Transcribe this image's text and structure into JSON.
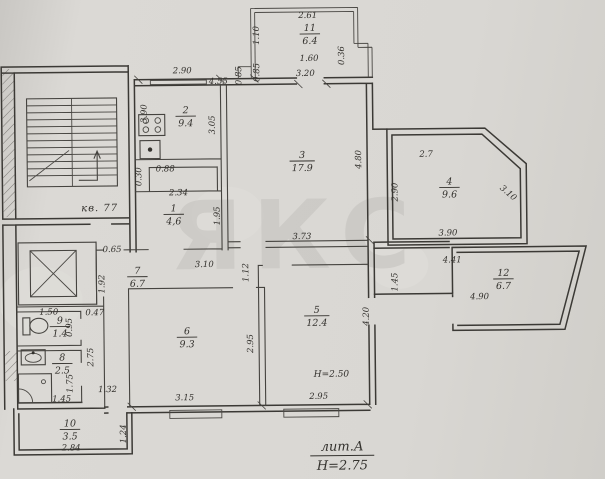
{
  "colors": {
    "paper": "#d8d6d1",
    "ink": "#3b3935",
    "watermark": "#c3c1bd"
  },
  "watermark": {
    "text": "ЯКС"
  },
  "apartment_label": {
    "text": "кв. 77"
  },
  "title_block": {
    "litera": "лит.А",
    "floor_height": "Н=2.75"
  },
  "annotations": [
    {
      "text": "Н=2.50",
      "x": 330,
      "y": 377
    }
  ],
  "rooms": [
    {
      "number": "1",
      "area": "4,6",
      "x": 174,
      "y": 210
    },
    {
      "number": "2",
      "area": "9.4",
      "x": 187,
      "y": 112
    },
    {
      "number": "3",
      "area": "17.9",
      "x": 303,
      "y": 158
    },
    {
      "number": "4",
      "area": "9.6",
      "x": 450,
      "y": 186
    },
    {
      "number": "5",
      "area": "12.4",
      "x": 316,
      "y": 313
    },
    {
      "number": "6",
      "area": "9.3",
      "x": 186,
      "y": 333
    },
    {
      "number": "7",
      "area": "6.7",
      "x": 137,
      "y": 272
    },
    {
      "number": "8",
      "area": "2.5",
      "x": 61,
      "y": 358
    },
    {
      "number": "9",
      "area": "1.4",
      "x": 59,
      "y": 321
    },
    {
      "number": "10",
      "area": "3.5",
      "x": 68,
      "y": 424
    },
    {
      "number": "11",
      "area": "6.4",
      "x": 312,
      "y": 31
    },
    {
      "number": "12",
      "area": "6.7",
      "x": 503,
      "y": 278
    }
  ],
  "dimensions": [
    {
      "t": "2.61",
      "x": 310,
      "y": 18,
      "r": 0
    },
    {
      "t": "1.10",
      "x": 261,
      "y": 35,
      "r": -90
    },
    {
      "t": "1.60",
      "x": 311,
      "y": 61,
      "r": 0
    },
    {
      "t": "0.36",
      "x": 346,
      "y": 56,
      "r": -90
    },
    {
      "t": "3.20",
      "x": 307,
      "y": 76,
      "r": 0
    },
    {
      "t": "0.85",
      "x": 243,
      "y": 75,
      "r": -90
    },
    {
      "t": "0.85",
      "x": 261,
      "y": 72,
      "r": -90
    },
    {
      "t": "4.55",
      "x": 220,
      "y": 83,
      "r": 0
    },
    {
      "t": "2.90",
      "x": 184,
      "y": 72,
      "r": 0
    },
    {
      "t": "3.90",
      "x": 148,
      "y": 112,
      "r": -90
    },
    {
      "t": "3.05",
      "x": 216,
      "y": 124,
      "r": -90
    },
    {
      "t": "0.88",
      "x": 166,
      "y": 170,
      "r": 0
    },
    {
      "t": "0.30",
      "x": 142,
      "y": 175,
      "r": -90
    },
    {
      "t": "2.34",
      "x": 179,
      "y": 194,
      "r": 0
    },
    {
      "t": "1.95",
      "x": 220,
      "y": 215,
      "r": -90
    },
    {
      "t": "4.80",
      "x": 362,
      "y": 160,
      "r": -90
    },
    {
      "t": "3.73",
      "x": 302,
      "y": 239,
      "r": 0
    },
    {
      "t": "2.7",
      "x": 427,
      "y": 158,
      "r": 0
    },
    {
      "t": "2.90",
      "x": 398,
      "y": 193,
      "r": -90
    },
    {
      "t": "3.10",
      "x": 507,
      "y": 197,
      "r": 41
    },
    {
      "t": "3.90",
      "x": 448,
      "y": 237,
      "r": 0
    },
    {
      "t": "4.41",
      "x": 452,
      "y": 264,
      "r": 0
    },
    {
      "t": "1.45",
      "x": 397,
      "y": 283,
      "r": -90
    },
    {
      "t": "4.90",
      "x": 479,
      "y": 301,
      "r": 0
    },
    {
      "t": "1.12",
      "x": 248,
      "y": 272,
      "r": -90
    },
    {
      "t": "4.20",
      "x": 368,
      "y": 317,
      "r": -90
    },
    {
      "t": "2.95",
      "x": 317,
      "y": 399,
      "r": 0
    },
    {
      "t": "2.95",
      "x": 252,
      "y": 343,
      "r": -90
    },
    {
      "t": "3.15",
      "x": 183,
      "y": 399,
      "r": 0
    },
    {
      "t": "3.10",
      "x": 204,
      "y": 266,
      "r": 0
    },
    {
      "t": "0.65",
      "x": 112,
      "y": 250,
      "r": 0
    },
    {
      "t": "1.92",
      "x": 104,
      "y": 282,
      "r": -90
    },
    {
      "t": "0.47",
      "x": 94,
      "y": 313,
      "r": 0
    },
    {
      "t": "1.50",
      "x": 48,
      "y": 312,
      "r": 0
    },
    {
      "t": "0.95",
      "x": 71,
      "y": 325,
      "r": -90
    },
    {
      "t": "2.75",
      "x": 92,
      "y": 355,
      "r": -90
    },
    {
      "t": "1.75",
      "x": 71,
      "y": 381,
      "r": -90
    },
    {
      "t": "1.45",
      "x": 60,
      "y": 399,
      "r": 0
    },
    {
      "t": "1.32",
      "x": 106,
      "y": 390,
      "r": 0
    },
    {
      "t": "2.84",
      "x": 69,
      "y": 448,
      "r": 0
    },
    {
      "t": "1.24",
      "x": 124,
      "y": 432,
      "r": -90
    }
  ],
  "icons": [
    "stove-icon",
    "kitchen-sink-icon",
    "toilet-icon",
    "washbasin-icon",
    "shower-tray-icon",
    "elevator-shaft-icon",
    "staircase-icon",
    "stair-direction-arrow-icon"
  ]
}
